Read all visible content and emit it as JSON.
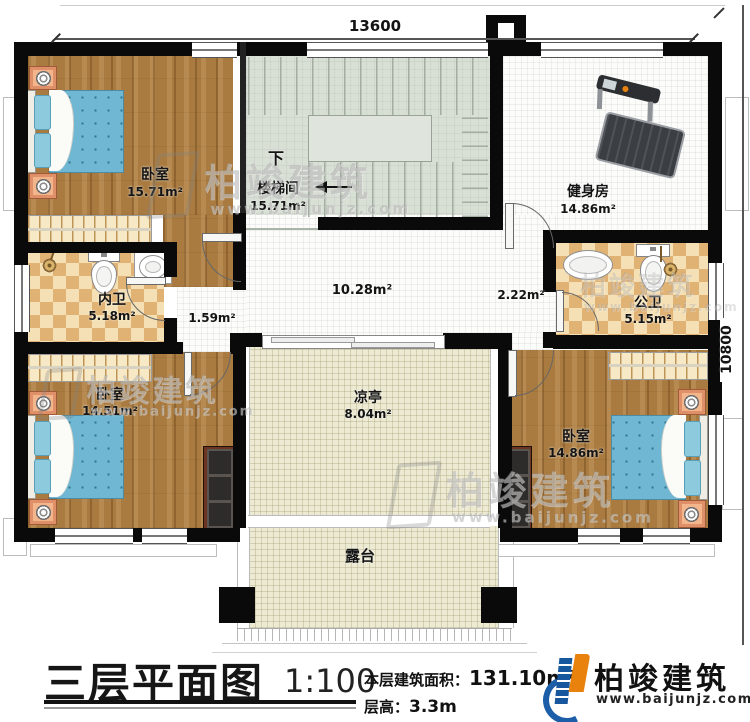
{
  "dimensions": {
    "width_mm": "13600",
    "height_mm": "10800"
  },
  "rooms": {
    "bedroom_tl": {
      "name": "卧室",
      "area": "15.71m²"
    },
    "stairwell": {
      "down": "下",
      "name": "楼梯间",
      "area": "15.71m²"
    },
    "gym": {
      "name": "健身房",
      "area": "14.86m²"
    },
    "bath_inner": {
      "name": "内卫",
      "area": "5.18m²"
    },
    "bath_public": {
      "name": "公卫",
      "area": "5.15m²"
    },
    "bedroom_bl": {
      "name": "卧室",
      "area": "14.51m²"
    },
    "bedroom_br": {
      "name": "卧室",
      "area": "14.86m²"
    },
    "pavilion": {
      "name": "凉亭",
      "area": "8.04m²"
    },
    "terrace": {
      "name": "露台"
    },
    "hall": {
      "area": "10.28m²"
    },
    "corridor": {
      "area": "1.59m²"
    },
    "vestibule": {
      "area": "2.22m²"
    }
  },
  "title_block": {
    "title": "三层平面图",
    "scale": "1:100",
    "area_label": "本层建筑面积：",
    "area_value": "131.10m²",
    "height_label": "层高：",
    "height_value": "3.3m"
  },
  "brand": {
    "name": "柏竣建筑",
    "website": "www.baijunjz.com"
  },
  "watermark": {
    "text": "柏竣建筑",
    "url": "www.baijunjz.com"
  },
  "colors": {
    "wall": "#0a0a0a",
    "wood": "#a97b41",
    "tile_checker": "#e0b274",
    "stair": "#d8dfd5",
    "terrace": "#edead4",
    "bed": "#6fb7d2",
    "brand_blue": "#1c5fa8",
    "brand_orange": "#e8820c"
  }
}
